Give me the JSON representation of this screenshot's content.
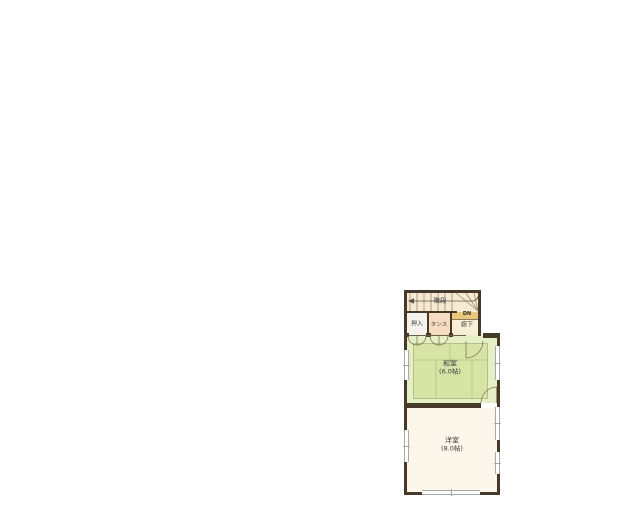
{
  "plan": {
    "title": "second-floor-plan",
    "stairs": {
      "label": "階段",
      "direction_label": "DN"
    },
    "storage": {
      "oshiire_label": "押入",
      "tansu_label": "タンス"
    },
    "hallway": {
      "label": "廊下"
    },
    "rooms": {
      "washitsu": {
        "name": "和室",
        "size": "(6.0帖)"
      },
      "youshitsu": {
        "name": "洋室",
        "size": "(8.0帖)"
      }
    },
    "colors": {
      "wall": "#46392a",
      "tatami": "#d7e4a6",
      "tatami_edge": "#e5eec5",
      "stairs_bg": "#f6ebd2",
      "hallway_bg": "#f8efd6",
      "tansu_bg": "#f6dcc0",
      "oshiire_bg": "#f5f3ec",
      "dn_strip_bg": "#e8c87f",
      "western_room_bg": "#fdf6ea",
      "page_bg": "#ffffff"
    }
  }
}
